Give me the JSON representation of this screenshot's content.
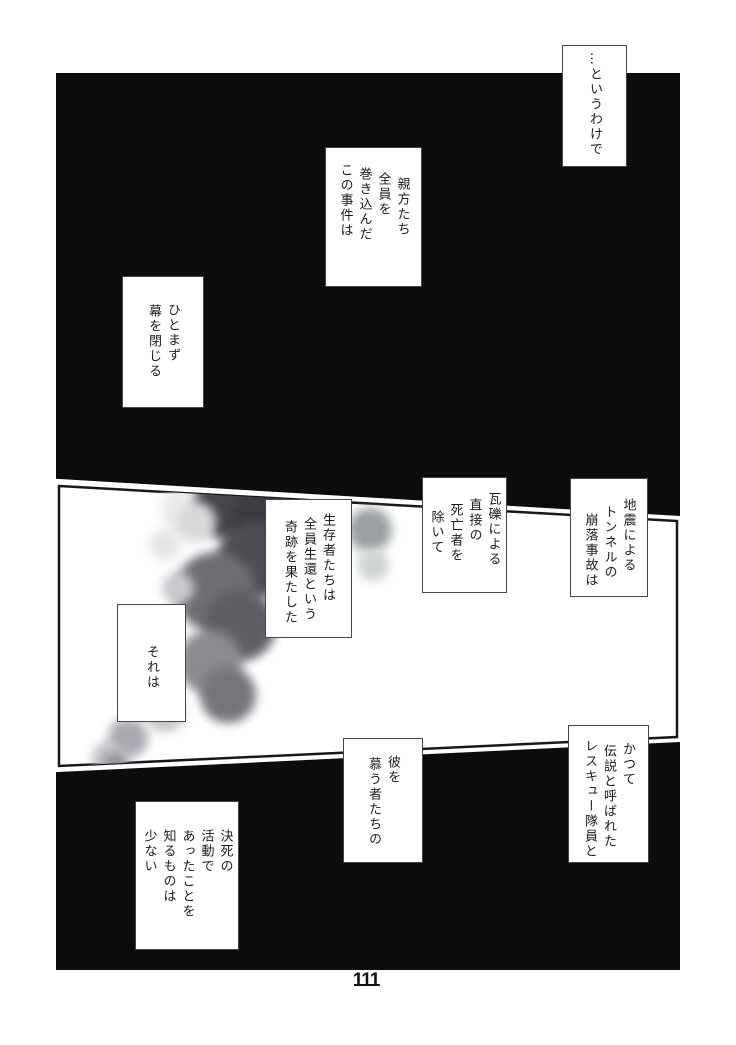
{
  "page": {
    "number": "111",
    "kind": "manga-page"
  },
  "colors": {
    "paper": "#ffffff",
    "panel_black": "#0c0c0c",
    "panel_border": "#181818",
    "balloon_bg": "#ffffff",
    "balloon_border": "#454545",
    "ink": "#1c1c1c",
    "smoke_dark": "#46464c",
    "smoke_mid": "#86868c",
    "smoke_light": "#d9d9db"
  },
  "artwork": {
    "middle_panel": "smoke-plume"
  },
  "balloons": [
    {
      "id": "narration-1",
      "lines": [
        "…というわけで"
      ]
    },
    {
      "id": "narration-2",
      "lines": [
        "親方たち",
        "全員を",
        "巻き込んだ",
        "この事件は"
      ]
    },
    {
      "id": "narration-3",
      "lines": [
        "ひとまず",
        "幕を閉じる"
      ]
    },
    {
      "id": "narration-4",
      "lines": [
        "地震による",
        "トンネルの",
        "崩落事故は"
      ]
    },
    {
      "id": "narration-5",
      "lines": [
        "瓦礫による",
        "直接の",
        "死亡者を",
        "除いて"
      ]
    },
    {
      "id": "narration-6",
      "lines": [
        "生存者たちは",
        "全員生還という",
        "奇跡を果たした"
      ]
    },
    {
      "id": "narration-7",
      "lines": [
        "それは"
      ]
    },
    {
      "id": "narration-8",
      "lines": [
        "かつて",
        "伝説と呼ばれた",
        "レスキュー隊員と"
      ]
    },
    {
      "id": "narration-9",
      "lines": [
        "彼を",
        "慕う者たちの"
      ]
    },
    {
      "id": "narration-10",
      "lines": [
        "決死の",
        "活動で",
        "あったことを",
        "知るものは",
        "少ない"
      ]
    }
  ]
}
